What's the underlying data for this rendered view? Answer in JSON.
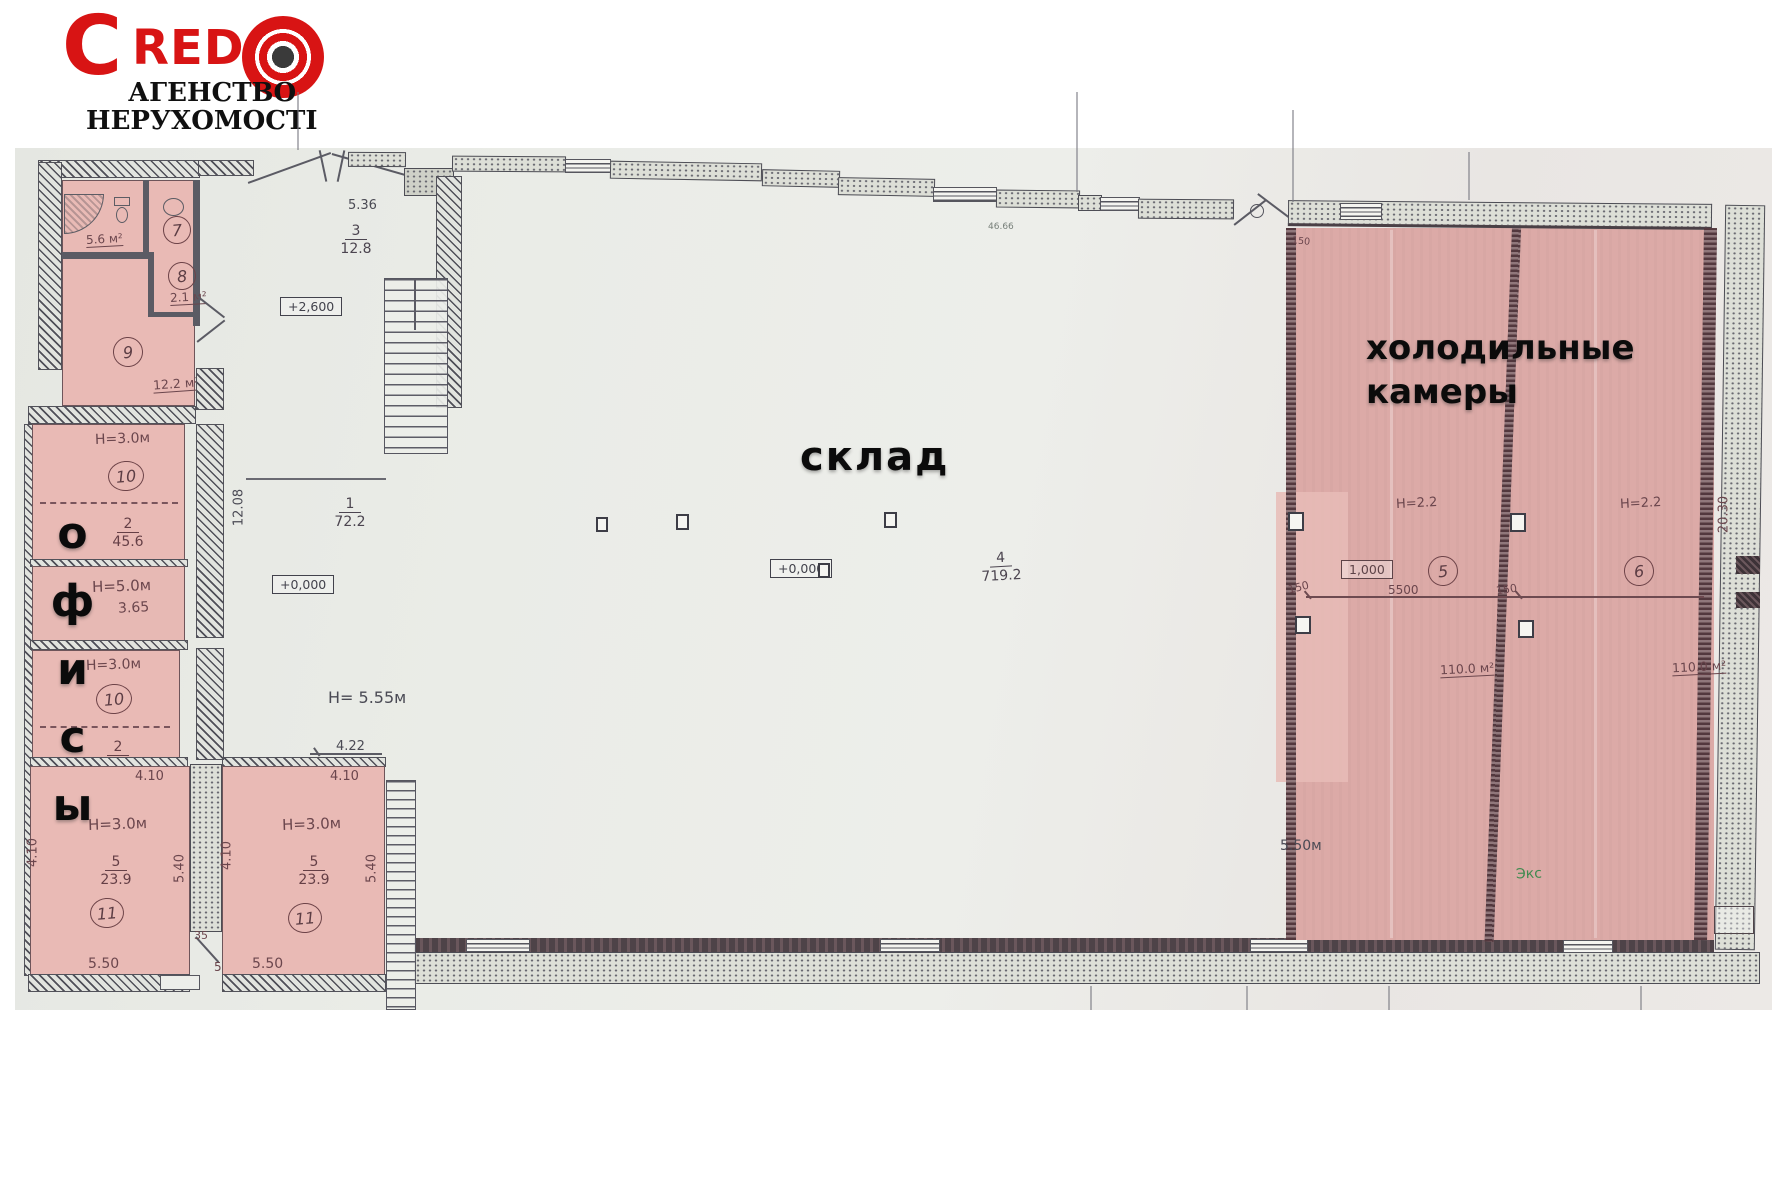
{
  "logo": {
    "brand_c": "C",
    "brand_rest": "RED",
    "tagline_line1": "АГЕНСТВО",
    "tagline_line2": "НЕРУХОМОСТІ",
    "brand_color": "#d81414"
  },
  "zones": {
    "warehouse": "склад",
    "cold_storage_line1": "холодильные",
    "cold_storage_line2": "камеры",
    "offices_vertical": "офисы"
  },
  "sanitary": {
    "room7": {
      "number": "7",
      "area": "5.6 м²"
    },
    "room8": {
      "number": "8",
      "area": "2.1 м²"
    },
    "room9": {
      "number": "9",
      "area": "12.2 м²"
    }
  },
  "offices": {
    "room10_upper": {
      "height": "Н=3.0м",
      "number": "10",
      "ratio_top": "2",
      "ratio_bottom": "45.6"
    },
    "room_mid": {
      "height": "Н=5.0м",
      "dim": "3.65"
    },
    "room10_lower": {
      "height": "Н=3.0м",
      "number": "10",
      "ratio_top": "2"
    },
    "room11_left": {
      "number": "11",
      "height": "Н=3.0м",
      "ratio_top": "5",
      "ratio_bottom": "23.9",
      "dim_top": "4.10",
      "dim_left": "4.10",
      "dim_right": "5.40",
      "dim_bottom": "5.50"
    },
    "room11_right": {
      "number": "11",
      "height": "Н=3.0м",
      "ratio_top": "5",
      "ratio_bottom": "23.9",
      "dim_above": "4.22",
      "dim_top": "4.10",
      "dim_left": "4.10",
      "dim_right": "5.40",
      "dim_bottom": "5.50"
    },
    "wall_thickness": "35",
    "dim_note": "50м"
  },
  "hall": {
    "dim_top": "5.36",
    "room3_ratio_top": "3",
    "room3_ratio_bottom": "12.8",
    "elevation_upper": "+2,600",
    "room1_ratio_top": "1",
    "room1_ratio_bottom": "72.2",
    "dim_left_vertical": "12.08",
    "elevation_zero": "+0,000",
    "ceiling_height": "Н= 5.55м",
    "dim_bottom": "4.22"
  },
  "warehouse": {
    "elevation_zero": "+0,000",
    "ratio_top": "4",
    "ratio_bottom": "719.2",
    "dim_top_faint": "46.66"
  },
  "cold_storage": {
    "room5": {
      "number": "5",
      "height": "Н=2.2",
      "elevation": "1,000",
      "dim_span": "5500",
      "dim_offset_left": "150",
      "dim_offset_right": "150",
      "area": "110.0 м²"
    },
    "room6": {
      "number": "6",
      "height": "Н=2.2",
      "area": "110.0 м²"
    },
    "dim_right_vertical": "20.30",
    "dim_wall_left": "5.50м",
    "dim_top_left": "150"
  },
  "annotations": {
    "bottom_right_note": "Экс"
  },
  "colors": {
    "brand_red": "#d81414",
    "room_pink": "#e9bab5",
    "cold_pink": "#dcaaa7",
    "paper": "#e8eae5",
    "wall_dark": "#4a4a52",
    "ink": "#474750"
  },
  "icons": {
    "bullseye": "bullseye-icon",
    "shower": "shower-icon",
    "toilet": "toilet-icon",
    "basin": "basin-icon",
    "entrance": "entrance-door-icon",
    "gable": "gable-vent-icon"
  }
}
